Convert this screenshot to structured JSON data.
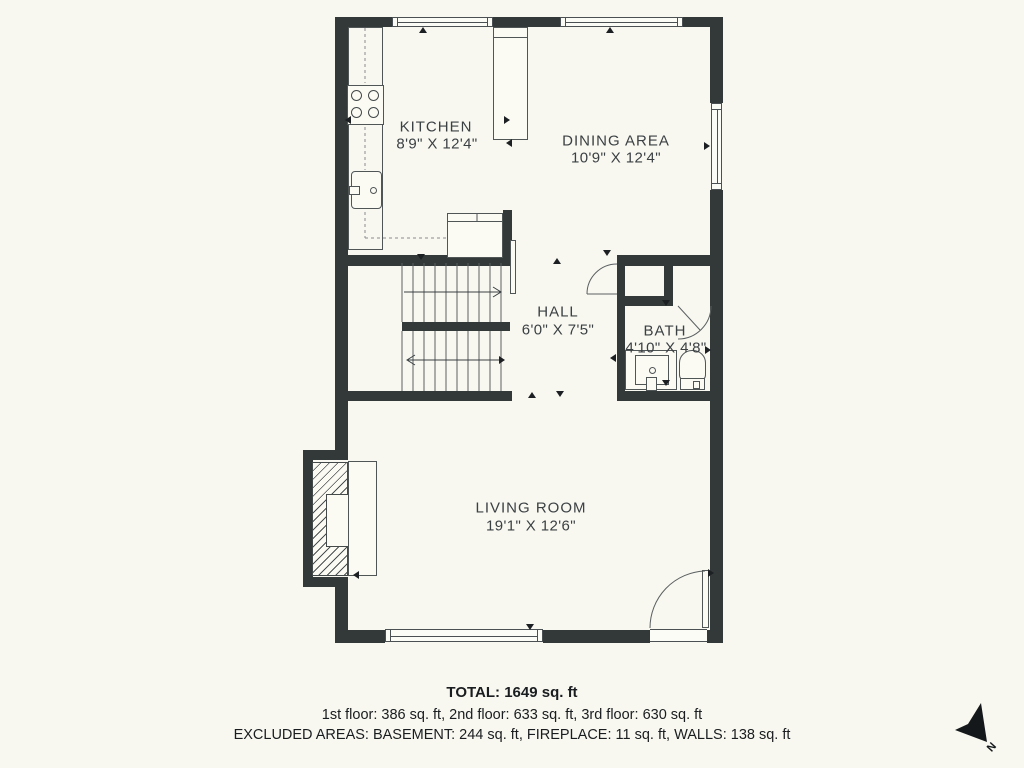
{
  "rooms": {
    "kitchen": {
      "name": "KITCHEN",
      "dims": "8'9\" X 12'4\""
    },
    "dining": {
      "name": "DINING AREA",
      "dims": "10'9\" X 12'4\""
    },
    "hall": {
      "name": "HALL",
      "dims": "6'0\" X 7'5\""
    },
    "bath": {
      "name": "BATH",
      "dims": "4'10\" X 4'8\""
    },
    "living": {
      "name": "LIVING ROOM",
      "dims": "19'1\" X 12'6\""
    }
  },
  "summary": {
    "total": "TOTAL: 1649 sq. ft",
    "floors": "1st floor: 386 sq. ft, 2nd floor: 633 sq. ft, 3rd floor: 630 sq. ft",
    "excluded": "EXCLUDED AREAS: BASEMENT: 244 sq. ft, FIREPLACE: 11 sq. ft, WALLS: 138 sq. ft"
  },
  "compass": {
    "label": "N"
  },
  "colors": {
    "background": "#f8f8f1",
    "wall": "#333839",
    "text": "#3b4043"
  }
}
